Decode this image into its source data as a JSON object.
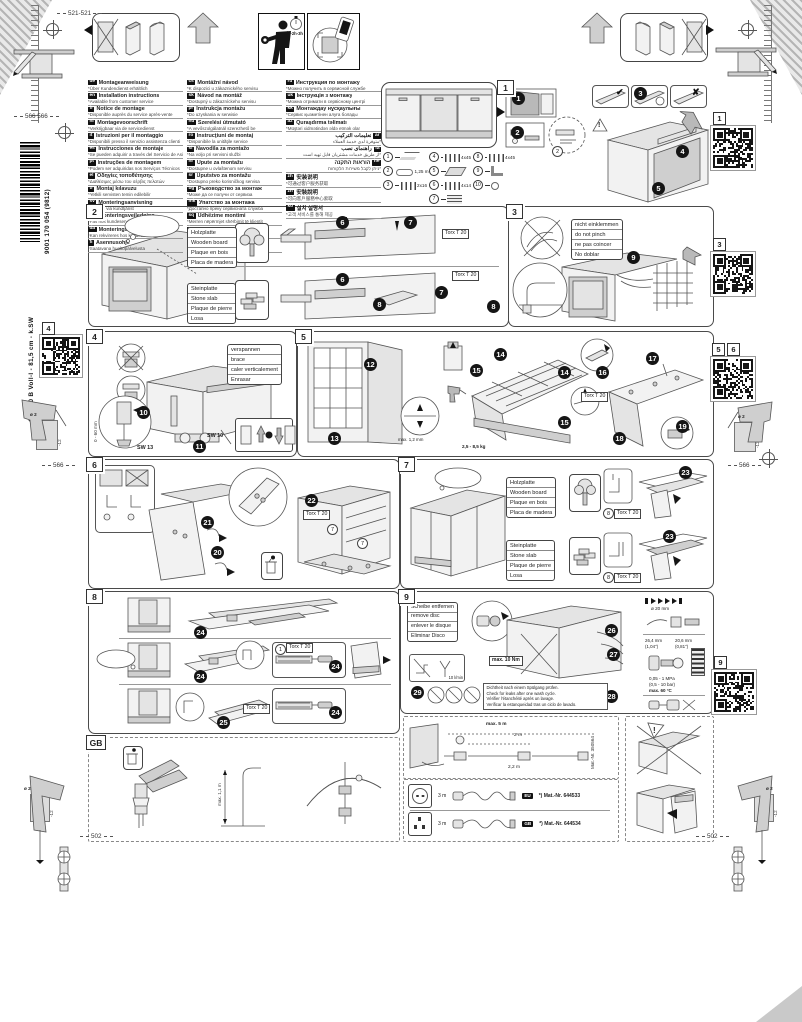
{
  "doc": {
    "time_estimate": "~2h-3h",
    "question_mark": "?",
    "exclamation": "!",
    "icons": {
      "check": "✔",
      "cross": "✘"
    }
  },
  "margins": {
    "dim_top_left": "521-521",
    "dim_left_upper": "566 566",
    "dim_left_mid": "566",
    "dim_right_mid": "566",
    "dim_bottom_left": "502",
    "dim_bottom_right": "502",
    "drill_dia": "ø 2",
    "drill_depth": "-12",
    "order_number": "9001 170 054 (9812)",
    "model_line": "GV 640 B Voll-I - 81,5 cm - k.SW",
    "qr_labels": {
      "q1": "1",
      "q3": "3",
      "q4": "4",
      "q5": "5",
      "q6": "6",
      "q9": "9"
    }
  },
  "languages": {
    "col1": [
      {
        "code": "de",
        "title": "Montageanweisung",
        "note": "*Über Kundendienst erhältlich"
      },
      {
        "code": "en",
        "title": "Installation instructions",
        "note": "*Available from customer service"
      },
      {
        "code": "fr",
        "title": "Notice de montage",
        "note": "*Disponible auprès du service après-vente"
      },
      {
        "code": "nl",
        "title": "Montagevoorschrift",
        "note": "*Verkrijgbaar via de servicedienst"
      },
      {
        "code": "it",
        "title": "Istruzioni per il montaggio",
        "note": "*Disponibili presso il servizio assistenza clienti"
      },
      {
        "code": "es",
        "title": "Instrucciones de montaje",
        "note": "*Se pueden adquirir a través del Servicio de Asistencia Técnica"
      },
      {
        "code": "pt",
        "title": "Instruções de montagem",
        "note": "*Podem ser adquiridas nos Serviços Técnicos"
      },
      {
        "code": "el",
        "title": "Οδηγίες τοποθέτησης",
        "note": "*Διαθέσιμες μέσω του σέρβις πελατών"
      },
      {
        "code": "tr",
        "title": "Montaj kılavuzu",
        "note": "*Yetkili servisten temin edilebilir"
      },
      {
        "code": "sv",
        "title": "Monteringsanvisning",
        "note": "*Kan fås via kundtjänst"
      },
      {
        "code": "no",
        "title": "Monteringsveiledning",
        "note": "*Fås hos kundeservice"
      },
      {
        "code": "da",
        "title": "Monteringsvejledning",
        "note": "*Kan rekvireres hos kundeservice"
      },
      {
        "code": "fi",
        "title": "Asennusohje",
        "note": "*Saatavana huoltopalvelusta"
      }
    ],
    "col2": [
      {
        "code": "cs",
        "title": "Montážní návod",
        "note": "*K dispozici u zákaznického servisu"
      },
      {
        "code": "sk",
        "title": "Návod na montáž",
        "note": "*Dostupný u zákazníckeho servisu"
      },
      {
        "code": "pl",
        "title": "Instrukcja montażu",
        "note": "*Do uzyskania w serwisie"
      },
      {
        "code": "hu",
        "title": "Szerelési útmutató",
        "note": "*A vevőszolgálatnál szerezhető be"
      },
      {
        "code": "ro",
        "title": "Instrucţiuni de montaj",
        "note": "*Disponibile la unităţile service"
      },
      {
        "code": "sl",
        "title": "Navodila za montažo",
        "note": "*Na voljo pri servisni službi"
      },
      {
        "code": "hr",
        "title": "Upute za montažu",
        "note": "*Dostupne u ovlaštenom servisu"
      },
      {
        "code": "sr",
        "title": "Uputstvo za montažu",
        "note": "*Dostupno preko korisničkog servisa"
      },
      {
        "code": "bg",
        "title": "Ръководство за монтаж",
        "note": "*Може да се получи от сервиза"
      },
      {
        "code": "mk",
        "title": "Упатство за монтажа",
        "note": "*Достапно преку сервисната служба"
      },
      {
        "code": "sq",
        "title": "Udhëzime montimi",
        "note": "*Merren nëpërmjet shërbimit të klientit"
      },
      {
        "code": "lv",
        "title": "Montāžas instrukcija",
        "note": "*Pieejama klientu servisā"
      },
      {
        "code": "lt",
        "title": "Montavimo instrukcija",
        "note": "*Gaunama klientų aptarnavimo tarnyboje"
      }
    ],
    "col3": [
      {
        "code": "ru",
        "title": "Инструкция по монтажу",
        "note": "*Можно получить в сервисной службе"
      },
      {
        "code": "uk",
        "title": "Інструкція з монтажу",
        "note": "*Можна отримати в сервісному центрі"
      },
      {
        "code": "kk",
        "title": "Монтаждау нұсқаулығы",
        "note": "*Сервис қызметінен алуға болады"
      },
      {
        "code": "az",
        "title": "Quraşdırma təlimatı",
        "note": "*Müştəri xidmətindən əldə etmək olar"
      },
      {
        "code": "ar",
        "title": "تعليمات التركيب",
        "note": "*متوفرة لدى خدمة العملاء",
        "dir": "rtl"
      },
      {
        "code": "fa",
        "title": "راهنمای نصب",
        "note": "*از طریق خدمات مشتریان قابل تهیه است",
        "dir": "rtl"
      },
      {
        "code": "he",
        "title": "הוראות התקנה",
        "note": "*ניתן לקבל משירות הלקוחות",
        "dir": "rtl"
      },
      {
        "code": "zh",
        "title": "安装说明",
        "note": "*可通过客户服务获取"
      },
      {
        "code": "zh",
        "title": "安裝說明",
        "note": "*可向客戶服務中心索取"
      },
      {
        "code": "ko",
        "title": "설치 설명서",
        "note": "*고객 서비스를 통해 제공"
      }
    ]
  },
  "p1": {
    "num": "1",
    "steps": [
      "1",
      "2",
      "3",
      "4",
      "5"
    ],
    "ref2": "2",
    "parts_col1": [
      {
        "no": "1",
        "icon": "strip",
        "spec": ""
      },
      {
        "no": "2",
        "icon": "hose",
        "spec": "1,25 m"
      },
      {
        "no": "3",
        "icon": "screws",
        "spec": "2x16"
      }
    ],
    "parts_col2": [
      {
        "no": "4",
        "icon": "screws",
        "spec": "4x45"
      },
      {
        "no": "5",
        "icon": "plates",
        "spec": ""
      },
      {
        "no": "6",
        "icon": "screws",
        "spec": "4x14"
      },
      {
        "no": "7",
        "icon": "stack",
        "spec": ""
      }
    ],
    "parts_col3": [
      {
        "no": "8",
        "icon": "screws",
        "spec": "4x45"
      },
      {
        "no": "9",
        "icon": "angles",
        "spec": ""
      },
      {
        "no": "10",
        "icon": "caps",
        "spec": ""
      }
    ]
  },
  "p2": {
    "num": "2",
    "wood": [
      "Holzplatte",
      "Wooden board",
      "Plaque en bois",
      "Placa de madera"
    ],
    "stone": [
      "Steinplatte",
      "Stone slab",
      "Plaque de pierre",
      "Losa"
    ],
    "torx": "Torx T 20",
    "s6": "6",
    "s7": "7",
    "s8": "8"
  },
  "p3": {
    "num": "3",
    "labels": [
      "nicht einklemmen",
      "do not pinch",
      "ne pas coincer",
      "No doblar"
    ],
    "s9": "9"
  },
  "p4": {
    "num": "4",
    "labels": [
      "verspannen",
      "brace",
      "caler verticalement",
      "Enrasar"
    ],
    "sw13": "SW 13",
    "sw10": "SW 10",
    "range": "0 - 60 mm",
    "s10": "10",
    "s11": "11"
  },
  "p5": {
    "num": "5",
    "s12": "12",
    "s13": "13",
    "s14": "14",
    "s15": "15",
    "s16": "16",
    "s17": "17",
    "s18": "18",
    "s19": "19",
    "weight": "2,5 - 8,5 kg",
    "gap": "max. 1,2 mm",
    "torx": "Torx T 20"
  },
  "p6": {
    "num": "6",
    "s20": "20",
    "s21": "21",
    "s22": "22",
    "torx": "Torx T 20",
    "ref7": "7"
  },
  "p7": {
    "num": "7",
    "wood": [
      "Holzplatte",
      "Wooden board",
      "Plaque en bois",
      "Placa de madera"
    ],
    "stone": [
      "Steinplatte",
      "Stone slab",
      "Plaque de pierre",
      "Losa"
    ],
    "torx": "Torx T 20",
    "s23": "23",
    "ref8": "8"
  },
  "p8": {
    "num": "8",
    "rows": [
      "24",
      "24",
      "25"
    ],
    "details": [
      "24",
      "24"
    ],
    "torx": "Torx T 20",
    "ref1": "1"
  },
  "p9": {
    "num": "9",
    "labels": [
      "Scheibe entfernen",
      "remove disc",
      "enlever le disque",
      "Eliminar Disco"
    ],
    "torque": "max. 10 Nm",
    "flow": "10 l/min",
    "s26": "26",
    "s27": "27",
    "s28": "28",
    "s29": "29",
    "warnings": [
      "Dichtheit nach einem Spülgang prüfen.",
      "Check for leaks after one wash cycle.",
      "Vérifier l'étanchéité après un lavage.",
      "Verificar la estanqueidad tras un ciclo de lavado."
    ],
    "specs": {
      "dia": "ø 20 mm",
      "d1": "26,4 mm",
      "d1in": "(1,04\")",
      "d2": "20,6 mm",
      "d2in": "(0,81\")",
      "press1": "0,05 - 1 MPa",
      "press2": "(0,5 - 10 bar)",
      "temp": "max. 60 °C"
    }
  },
  "gb": {
    "num": "GB",
    "height": "max. 1,1 m"
  },
  "hose_ext": {
    "total": "max. 5 m",
    "mid": "2 m",
    "bottom": "2,2 m",
    "mat": "Mat.-Nr. 350564"
  },
  "cords": [
    {
      "type": "eu",
      "len": "3 m",
      "badge": "EU",
      "mat": "*) Mat.-Nr. 644533"
    },
    {
      "type": "uk",
      "len": "3 m",
      "badge": "GB",
      "mat": "*) Mat.-Nr. 644534"
    }
  ]
}
